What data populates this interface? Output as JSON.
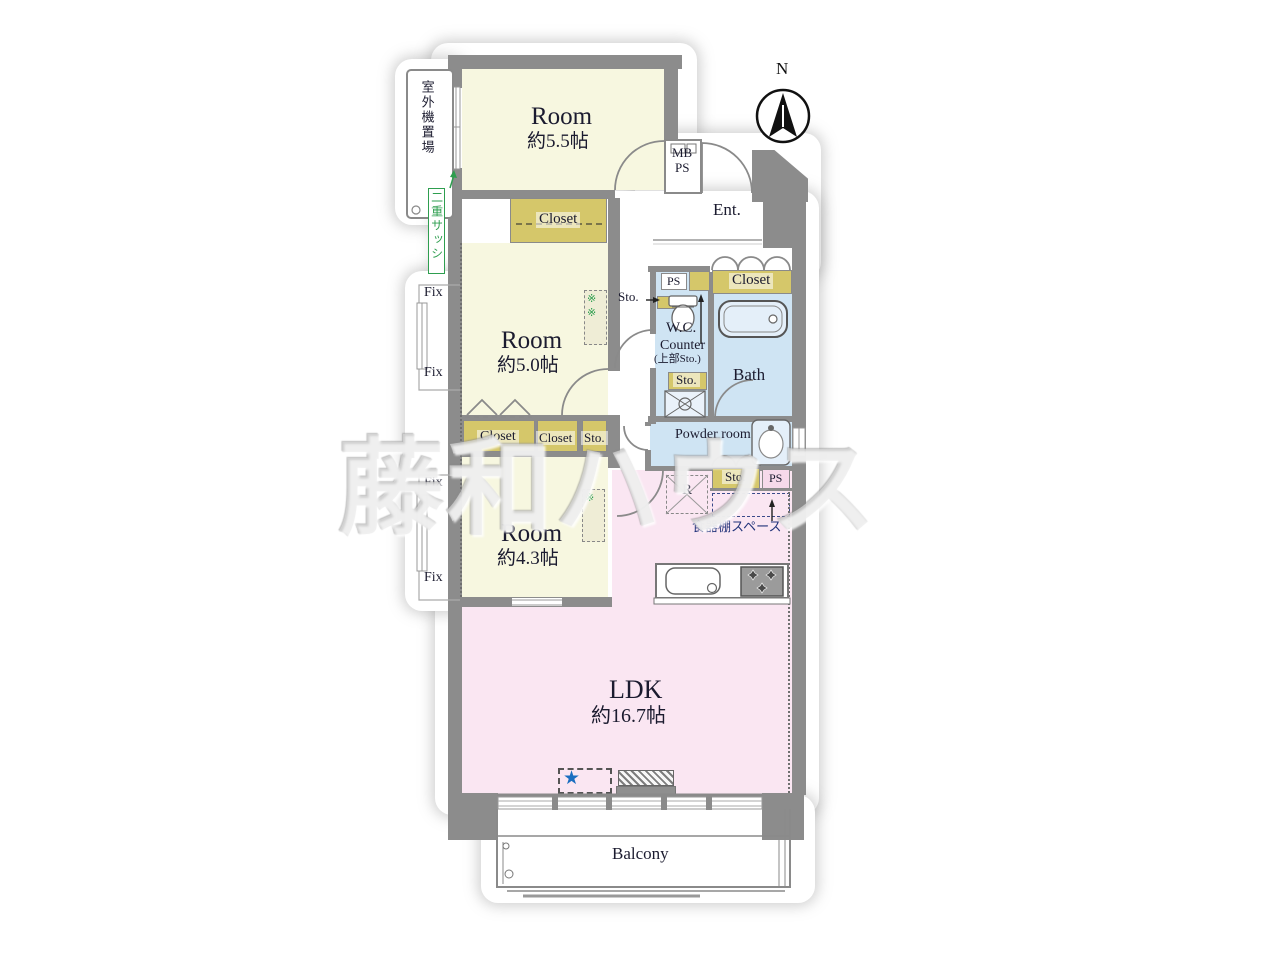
{
  "floorplan": {
    "compass": {
      "north": "N"
    },
    "watermark": "藤和ハウス",
    "rooms": {
      "bedroom1": {
        "label": "Room",
        "size": "約5.5帖"
      },
      "bedroom2": {
        "label": "Room",
        "size": "約5.0帖"
      },
      "bedroom3": {
        "label": "Room",
        "size": "約4.3帖"
      },
      "ldk": {
        "label": "LDK",
        "size": "約16.7帖"
      },
      "entrance": {
        "label": "Ent."
      },
      "wc": {
        "label": "W.C."
      },
      "wc_counter": {
        "label": "Counter",
        "note": "(上部Sto.)"
      },
      "bath": {
        "label": "Bath"
      },
      "powder_room": {
        "label": "Powder room"
      },
      "balcony": {
        "label": "Balcony"
      }
    },
    "storage": {
      "closet": "Closet",
      "sto": "Sto.",
      "ps": "PS",
      "mb": "MB",
      "refrigerator": "R",
      "dish_shelf_space": "食器棚スペース"
    },
    "annotations": {
      "fix": "Fix",
      "outdoor_unit": "室外機置場",
      "double_sash": "二重サッシ",
      "note": "※",
      "star": "★"
    },
    "colors": {
      "wall": "#8c8c8c",
      "room_yellow": "#f7f7e0",
      "ldk_pink": "#fae6f2",
      "wet_blue": "#cfe4f3",
      "closet_olive": "#d5c76a",
      "sash_green": "#2e9e4f",
      "navy_text": "#22337a",
      "star_blue": "#1b6ec0"
    }
  }
}
